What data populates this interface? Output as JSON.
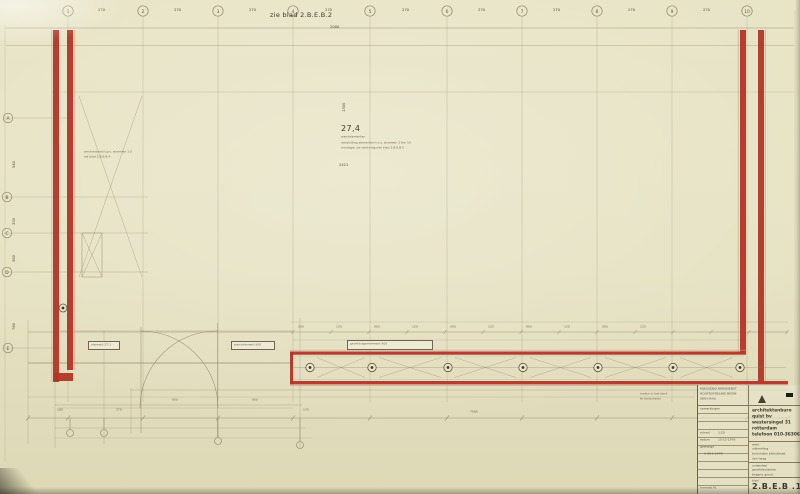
{
  "sheet": {
    "ref_note": "zie blad 2.B.E.B.2",
    "ref_dim": "2000"
  },
  "grid": {
    "top_labels": [
      "1",
      "2",
      "3",
      "4",
      "5",
      "6",
      "7",
      "8",
      "9",
      "10"
    ],
    "top_dims": [
      "270",
      "270",
      "270",
      "270",
      "270",
      "270",
      "270",
      "270",
      "270"
    ],
    "left_labels": [
      "A",
      "B",
      "C",
      "D",
      "E"
    ],
    "left_dims": [
      "540",
      "330",
      "380",
      "760"
    ]
  },
  "detail": {
    "number": "27,4",
    "caption": "wandelementen",
    "note1": "aansluiting elementen t.o.v. stramien 1 t/m 10",
    "note2": "montage: zie werkvolgorde blad 2.B.E.B.5",
    "dim": "2421",
    "vert_dim": "1300"
  },
  "notes": {
    "brace1": "windverband t.p.v. stramien 1-2",
    "brace2": "zie blad 2.B.E.B.4",
    "tb1": "maten in het werk",
    "tb2": "te kontroleren"
  },
  "labels": {
    "box_left": "element 27.1",
    "box_mid": "wandelement 900",
    "box_band": "geveldragerelement 900"
  },
  "band": {
    "dims": [
      "900",
      "120",
      "900",
      "120",
      "900",
      "120",
      "900",
      "120",
      "900",
      "120"
    ]
  },
  "bottom_dims": [
    "180",
    "270",
    "900",
    "900",
    "170",
    "7560"
  ],
  "titleblock": {
    "org1": "RIJKSGEBOUWENDIENST",
    "org2": "HOOFDAFDELING BEGIN",
    "org3": "DEN HAAG",
    "opmerkingen": "opmerkingen",
    "schaal_label": "schaal",
    "schaal": "1:20",
    "datum_label": "datum",
    "datum": "15-12-1976",
    "gewijzigd_label": "gewijzigd",
    "gewijzigd": "A  20-1-1978",
    "formaat": "formaat A1",
    "firm1": "architektenburo",
    "firm2": "quist bv",
    "firm3": "westersingel 31",
    "firm4": "rotterdam",
    "firm5": "telefoon 010-363066",
    "werk_label": "werk",
    "werk1": "uitbreiding",
    "werk2": "koninklijke bibliotheek",
    "werk3": "den haag",
    "onderdeel_label": "onderdeel",
    "onderdeel1": "gevelelementen",
    "onderdeel2": "begane grond",
    "blad_label": "blad",
    "blad": "2.B.E.B .1"
  }
}
